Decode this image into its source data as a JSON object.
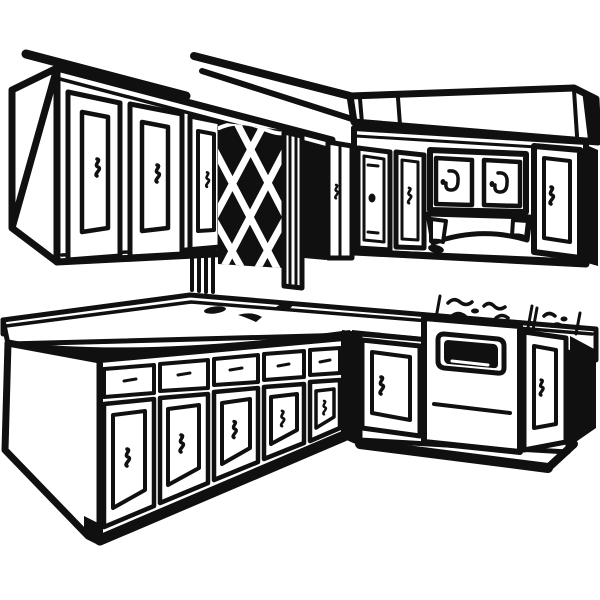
{
  "scene": {
    "style": "black-and-white clipart line drawing",
    "subject": "L-shaped kitchen: upper wall cabinets with a lattice-front cabinet, soffit, lower base cabinets with drawers and doors, countertop with cooktop burners and a range oven",
    "colors": {
      "paper": "#ffffff",
      "ink": "#101010"
    },
    "objects": [
      "ceiling-line",
      "upper-cabinets-left",
      "lattice-cabinet",
      "soffit",
      "upper-cabinets-right",
      "valance",
      "countertop",
      "cooktop-burners",
      "base-cabinets-left",
      "oven",
      "base-cabinets-right"
    ]
  }
}
